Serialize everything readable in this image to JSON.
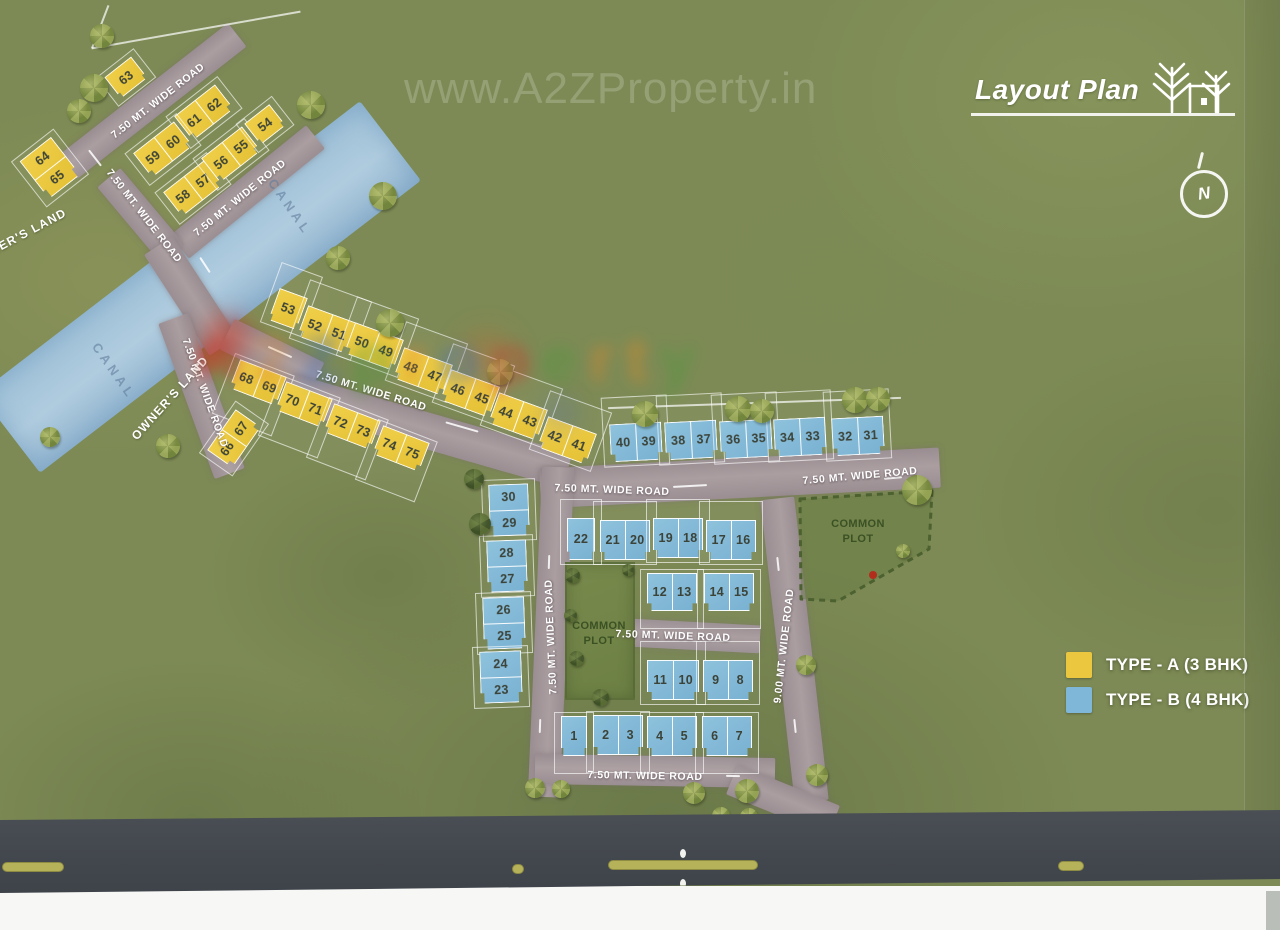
{
  "header": {
    "title": "Layout Plan"
  },
  "compass_letter": "N",
  "watermarks": {
    "top": "www.A2ZProperty.in",
    "letters": [
      {
        "ch": "A",
        "c": "#c93a2e"
      },
      {
        "ch": "2",
        "c": "#e0862b"
      },
      {
        "ch": "Z",
        "c": "#3e6fbe"
      },
      {
        "ch": "p",
        "c": "#4a9a3c"
      },
      {
        "ch": "r",
        "c": "#e0862b"
      },
      {
        "ch": "o",
        "c": "#3e6fbe"
      },
      {
        "ch": "p",
        "c": "#c93a2e"
      },
      {
        "ch": "e",
        "c": "#4a9a3c"
      },
      {
        "ch": "r",
        "c": "#e0862b"
      },
      {
        "ch": "t",
        "c": "#e08b28"
      },
      {
        "ch": "y",
        "c": "#4a9a3c"
      }
    ]
  },
  "legend": {
    "items": [
      {
        "label": "TYPE - A (3 BHK)",
        "color": "#eac73e"
      },
      {
        "label": "TYPE - B (4 BHK)",
        "color": "#7fb7d9"
      }
    ]
  },
  "colors": {
    "type_a": "#eac73e",
    "type_b": "#7fb7d9",
    "road": "#a2969a",
    "canal": "#a9cbe2"
  },
  "map": {
    "canal": {
      "x": 200,
      "y": 287,
      "len": 480,
      "wid": 100,
      "rot": -37.5
    },
    "roads": [
      [
        152,
        101,
        215,
        30,
        -38
      ],
      [
        247,
        192,
        175,
        30,
        -39
      ],
      [
        141,
        216,
        100,
        30,
        50
      ],
      [
        191,
        296,
        120,
        34,
        57
      ],
      [
        201,
        396,
        165,
        32,
        70
      ],
      [
        272,
        356,
        100,
        34,
        26
      ],
      [
        428,
        431,
        290,
        36,
        16
      ],
      [
        740,
        478,
        400,
        40,
        -3
      ],
      [
        551,
        632,
        330,
        32,
        92.5
      ],
      [
        794,
        650,
        305,
        34,
        83.5
      ],
      [
        695,
        636,
        130,
        28,
        3
      ],
      [
        655,
        771,
        240,
        30,
        1
      ],
      [
        783,
        800,
        110,
        32,
        22
      ]
    ],
    "road_labels": [
      {
        "t": "7.50 MT. WIDE ROAD",
        "x": 158,
        "y": 101,
        "r": -38
      },
      {
        "t": "7.50 MT. WIDE ROAD",
        "x": 144,
        "y": 216,
        "r": 52
      },
      {
        "t": "7.50 MT. WIDE ROAD",
        "x": 240,
        "y": 198,
        "r": -39
      },
      {
        "t": "7.50 MT. WIDE ROAD",
        "x": 205,
        "y": 393,
        "r": 70
      },
      {
        "t": "7.50 MT. WIDE ROAD",
        "x": 371,
        "y": 391,
        "r": 17
      },
      {
        "t": "7.50 MT. WIDE ROAD",
        "x": 612,
        "y": 490,
        "r": 2
      },
      {
        "t": "7.50 MT. WIDE ROAD",
        "x": 860,
        "y": 476,
        "r": -5
      },
      {
        "t": "7.50 MT. WIDE ROAD",
        "x": 551,
        "y": 637,
        "r": -92.5
      },
      {
        "t": "9.00 MT. WIDE ROAD",
        "x": 784,
        "y": 646,
        "r": -83.5
      },
      {
        "t": "7.50 MT. WIDE ROAD",
        "x": 673,
        "y": 636,
        "r": 2
      },
      {
        "t": "7.50 MT. WIDE ROAD",
        "x": 645,
        "y": 776,
        "r": 1
      }
    ],
    "area_labels": [
      {
        "t": "OWNER'S LAND",
        "x": 170,
        "y": 398,
        "r": -48,
        "cls": "area-label"
      },
      {
        "t": "OWNER'S LAND",
        "x": 18,
        "y": 237,
        "r": -28,
        "cls": "area-label"
      },
      {
        "t": "CANAL",
        "x": 290,
        "y": 207,
        "r": 55,
        "cls": "canal-label"
      },
      {
        "t": "CANAL",
        "x": 114,
        "y": 371,
        "r": 55,
        "cls": "canal-label"
      },
      {
        "t": "COMMON PLOT",
        "x": 599,
        "y": 634,
        "r": 0,
        "cls": "cp-label"
      },
      {
        "t": "COMMON PLOT",
        "x": 858,
        "y": 532,
        "r": 0,
        "cls": "cp-label"
      }
    ],
    "common_left": {
      "x": 565,
      "y": 562,
      "w": 70,
      "h": 138
    },
    "common_right_points": "800,499 932,491 929,549 838,601 801,599",
    "plots": [
      {
        "n": [
          "63"
        ],
        "t": "A",
        "x": 126,
        "y": 77,
        "w": 34,
        "h": 27,
        "r": -38
      },
      {
        "n": [
          "64",
          "65"
        ],
        "t": "A",
        "x": 50,
        "y": 168,
        "w": 40,
        "h": 48,
        "r": -38,
        "s": 1
      },
      {
        "n": [
          "61",
          "62"
        ],
        "t": "A",
        "x": 204,
        "y": 112,
        "w": 52,
        "h": 31,
        "r": -38
      },
      {
        "n": [
          "59",
          "60"
        ],
        "t": "A",
        "x": 163,
        "y": 149,
        "w": 52,
        "h": 31,
        "r": -38
      },
      {
        "n": [
          "58",
          "57"
        ],
        "t": "A",
        "x": 193,
        "y": 188,
        "w": 52,
        "h": 31,
        "r": -38
      },
      {
        "n": [
          "56",
          "55"
        ],
        "t": "A",
        "x": 231,
        "y": 154,
        "w": 52,
        "h": 31,
        "r": -38
      },
      {
        "n": [
          "54"
        ],
        "t": "A",
        "x": 265,
        "y": 124,
        "w": 32,
        "h": 27,
        "r": -38
      },
      {
        "n": [
          "53"
        ],
        "t": "A",
        "x": 288,
        "y": 309,
        "w": 30,
        "h": 34,
        "r": 20,
        "e": "u",
        "ea": 20
      },
      {
        "n": [
          "52",
          "51"
        ],
        "t": "A",
        "x": 327,
        "y": 329,
        "w": 52,
        "h": 33,
        "r": 20,
        "e": "u",
        "ea": 20
      },
      {
        "n": [
          "50",
          "49"
        ],
        "t": "A",
        "x": 374,
        "y": 346,
        "w": 52,
        "h": 33,
        "r": 20,
        "e": "u",
        "ea": 20
      },
      {
        "n": [
          "48",
          "47"
        ],
        "t": "A",
        "x": 423,
        "y": 371,
        "w": 52,
        "h": 33,
        "r": 20,
        "e": "u",
        "ea": 20
      },
      {
        "n": [
          "46",
          "45"
        ],
        "t": "A",
        "x": 470,
        "y": 393,
        "w": 52,
        "h": 33,
        "r": 20,
        "e": "u",
        "ea": 20
      },
      {
        "n": [
          "44",
          "43"
        ],
        "t": "A",
        "x": 518,
        "y": 416,
        "w": 52,
        "h": 33,
        "r": 20,
        "e": "u",
        "ea": 20
      },
      {
        "n": [
          "42",
          "41"
        ],
        "t": "A",
        "x": 567,
        "y": 440,
        "w": 52,
        "h": 33,
        "r": 20,
        "e": "u",
        "ea": 20
      },
      {
        "n": [
          "68",
          "69"
        ],
        "t": "A",
        "x": 258,
        "y": 382,
        "w": 50,
        "h": 31,
        "r": 21,
        "e": "d",
        "ea": 24
      },
      {
        "n": [
          "70",
          "71"
        ],
        "t": "A",
        "x": 304,
        "y": 404,
        "w": 50,
        "h": 31,
        "r": 21,
        "e": "d",
        "ea": 24
      },
      {
        "n": [
          "72",
          "73"
        ],
        "t": "A",
        "x": 352,
        "y": 426,
        "w": 50,
        "h": 31,
        "r": 21,
        "e": "d",
        "ea": 24
      },
      {
        "n": [
          "74",
          "75"
        ],
        "t": "A",
        "x": 401,
        "y": 448,
        "w": 50,
        "h": 31,
        "r": 21,
        "e": "d",
        "ea": 24
      },
      {
        "n": [
          "66",
          "67"
        ],
        "t": "A",
        "x": 234,
        "y": 438,
        "w": 50,
        "h": 31,
        "r": -55
      },
      {
        "n": [
          "40",
          "39"
        ],
        "t": "B",
        "x": 636,
        "y": 442,
        "w": 52,
        "h": 38,
        "r": -3,
        "e": "u",
        "ea": 22
      },
      {
        "n": [
          "38",
          "37"
        ],
        "t": "B",
        "x": 691,
        "y": 440,
        "w": 52,
        "h": 38,
        "r": -3,
        "e": "u",
        "ea": 22
      },
      {
        "n": [
          "36",
          "35"
        ],
        "t": "B",
        "x": 746,
        "y": 439,
        "w": 52,
        "h": 38,
        "r": -3,
        "e": "u",
        "ea": 22
      },
      {
        "n": [
          "34",
          "33"
        ],
        "t": "B",
        "x": 800,
        "y": 437,
        "w": 52,
        "h": 38,
        "r": -3,
        "e": "u",
        "ea": 22
      },
      {
        "n": [
          "32",
          "31"
        ],
        "t": "B",
        "x": 858,
        "y": 436,
        "w": 52,
        "h": 38,
        "r": -3,
        "e": "u",
        "ea": 22
      },
      {
        "n": [
          "22"
        ],
        "t": "B",
        "x": 581,
        "y": 539,
        "w": 28,
        "h": 42,
        "r": 0,
        "e": "u",
        "ea": 14
      },
      {
        "n": [
          "21",
          "20"
        ],
        "t": "B",
        "x": 625,
        "y": 540,
        "w": 50,
        "h": 40,
        "r": 0,
        "e": "u",
        "ea": 14
      },
      {
        "n": [
          "19",
          "18"
        ],
        "t": "B",
        "x": 678,
        "y": 538,
        "w": 50,
        "h": 40,
        "r": 0,
        "e": "u",
        "ea": 14
      },
      {
        "n": [
          "17",
          "16"
        ],
        "t": "B",
        "x": 731,
        "y": 540,
        "w": 50,
        "h": 40,
        "r": 0,
        "e": "u",
        "ea": 14
      },
      {
        "n": [
          "12",
          "13"
        ],
        "t": "B",
        "x": 672,
        "y": 592,
        "w": 50,
        "h": 38,
        "r": 0,
        "e": "d",
        "ea": 12
      },
      {
        "n": [
          "14",
          "15"
        ],
        "t": "B",
        "x": 729,
        "y": 592,
        "w": 50,
        "h": 38,
        "r": 0,
        "e": "d",
        "ea": 12
      },
      {
        "n": [
          "11",
          "10"
        ],
        "t": "B",
        "x": 673,
        "y": 680,
        "w": 52,
        "h": 40,
        "r": 0,
        "e": "u",
        "ea": 14
      },
      {
        "n": [
          "9",
          "8"
        ],
        "t": "B",
        "x": 728,
        "y": 680,
        "w": 50,
        "h": 40,
        "r": 0,
        "e": "u",
        "ea": 14
      },
      {
        "n": [
          "1"
        ],
        "t": "B",
        "x": 574,
        "y": 736,
        "w": 26,
        "h": 40,
        "r": 0,
        "e": "d",
        "ea": 12
      },
      {
        "n": [
          "2",
          "3"
        ],
        "t": "B",
        "x": 618,
        "y": 735,
        "w": 50,
        "h": 40,
        "r": 0,
        "e": "d",
        "ea": 12
      },
      {
        "n": [
          "4",
          "5"
        ],
        "t": "B",
        "x": 672,
        "y": 736,
        "w": 50,
        "h": 40,
        "r": 0,
        "e": "d",
        "ea": 12
      },
      {
        "n": [
          "6",
          "7"
        ],
        "t": "B",
        "x": 727,
        "y": 736,
        "w": 50,
        "h": 40,
        "r": 0,
        "e": "d",
        "ea": 12
      },
      {
        "n": [
          "30",
          "29"
        ],
        "t": "B",
        "x": 509,
        "y": 510,
        "w": 40,
        "h": 52,
        "r": -2,
        "s": 1
      },
      {
        "n": [
          "28",
          "27"
        ],
        "t": "B",
        "x": 507,
        "y": 566,
        "w": 40,
        "h": 52,
        "r": -2,
        "s": 1
      },
      {
        "n": [
          "26",
          "25"
        ],
        "t": "B",
        "x": 504,
        "y": 623,
        "w": 42,
        "h": 52,
        "r": -2,
        "s": 1
      },
      {
        "n": [
          "24",
          "23"
        ],
        "t": "B",
        "x": 501,
        "y": 677,
        "w": 42,
        "h": 52,
        "r": -2,
        "s": 1
      }
    ],
    "trees": [
      [
        102,
        36,
        24,
        0
      ],
      [
        94,
        88,
        28,
        0
      ],
      [
        79,
        111,
        24,
        0
      ],
      [
        311,
        105,
        28,
        0
      ],
      [
        383,
        196,
        28,
        0
      ],
      [
        338,
        258,
        24,
        0
      ],
      [
        390,
        323,
        28,
        0
      ],
      [
        168,
        446,
        24,
        0
      ],
      [
        50,
        437,
        20,
        0
      ],
      [
        500,
        372,
        26,
        0
      ],
      [
        645,
        414,
        26,
        0
      ],
      [
        738,
        409,
        26,
        0
      ],
      [
        762,
        411,
        24,
        0
      ],
      [
        855,
        400,
        26,
        0
      ],
      [
        878,
        399,
        24,
        0
      ],
      [
        917,
        490,
        30,
        0
      ],
      [
        903,
        551,
        14,
        0
      ],
      [
        806,
        665,
        20,
        0
      ],
      [
        817,
        775,
        22,
        0
      ],
      [
        747,
        791,
        24,
        0
      ],
      [
        694,
        793,
        22,
        0
      ],
      [
        721,
        816,
        18,
        0
      ],
      [
        749,
        817,
        18,
        0
      ],
      [
        535,
        788,
        20,
        0
      ],
      [
        561,
        789,
        18,
        0
      ],
      [
        474,
        479,
        20,
        1
      ],
      [
        480,
        524,
        22,
        1
      ],
      [
        572,
        575,
        15,
        1
      ],
      [
        570,
        615,
        13,
        1
      ],
      [
        576,
        658,
        15,
        1
      ],
      [
        600,
        697,
        17,
        1
      ],
      [
        628,
        570,
        12,
        1
      ]
    ],
    "dashes": [
      [
        245,
        158,
        26,
        -38
      ],
      [
        95,
        158,
        20,
        52
      ],
      [
        205,
        265,
        18,
        57
      ],
      [
        280,
        352,
        26,
        24
      ],
      [
        462,
        427,
        34,
        16
      ],
      [
        690,
        486,
        34,
        -3
      ],
      [
        893,
        478,
        18,
        -5
      ],
      [
        549,
        562,
        14,
        92
      ],
      [
        778,
        564,
        14,
        84
      ],
      [
        540,
        726,
        14,
        92
      ],
      [
        795,
        726,
        14,
        84
      ],
      [
        733,
        776,
        14,
        1
      ]
    ],
    "lines": [
      [
        196,
        30,
        212,
        -10
      ],
      [
        100,
        27,
        46,
        -69
      ],
      [
        754,
        403,
        293,
        -2
      ]
    ],
    "blobs": [
      [
        228,
        338,
        24,
        "rgba(200,45,25,0.45)"
      ],
      [
        207,
        356,
        13,
        "rgba(200,45,25,0.35)"
      ],
      [
        487,
        358,
        28,
        "rgba(235,95,40,0.22)"
      ],
      [
        560,
        413,
        20,
        "rgba(70,100,200,0.15)"
      ],
      [
        873,
        575,
        4,
        "rgba(190,30,20,0.85)"
      ]
    ],
    "bottom_road": {
      "bars": [
        [
          2,
          52,
          62
        ],
        [
          512,
          54,
          12
        ],
        [
          608,
          50,
          150
        ],
        [
          1058,
          51,
          26
        ]
      ],
      "dots": [
        [
          680,
          39
        ],
        [
          680,
          69
        ]
      ]
    }
  }
}
